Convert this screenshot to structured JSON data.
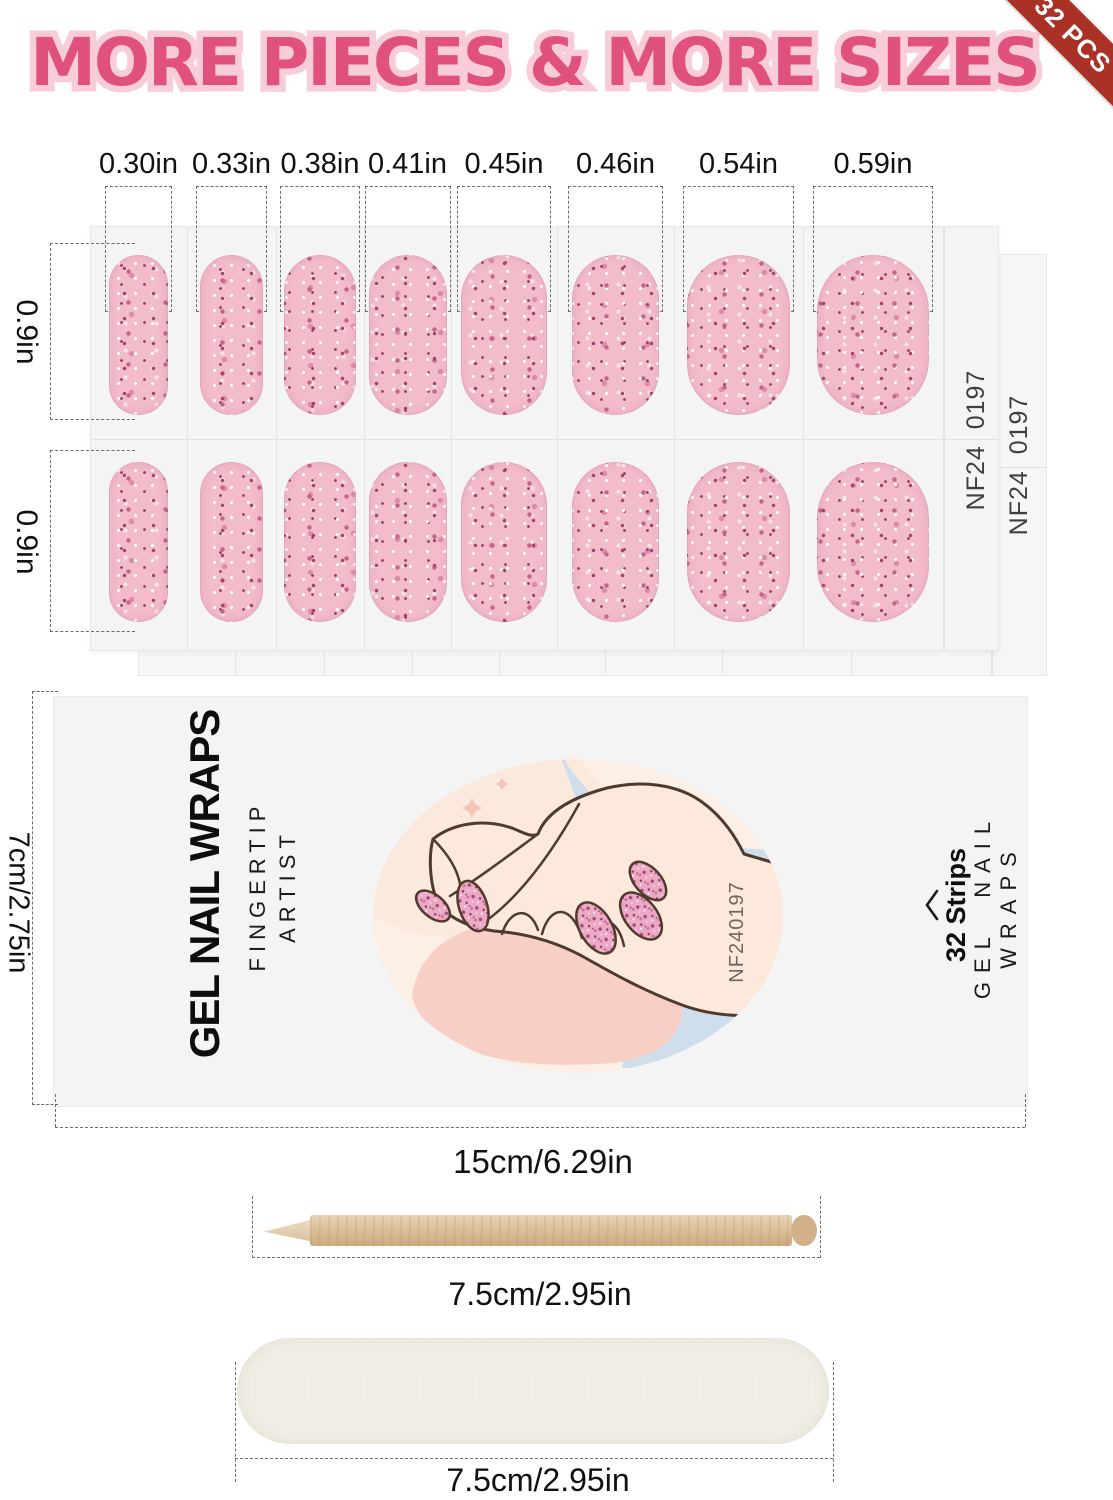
{
  "badge": {
    "label": "32 PCS"
  },
  "title": {
    "text": "MORE PIECES & MORE SIZES"
  },
  "sheet": {
    "size_labels": [
      "0.30in",
      "0.33in",
      "0.38in",
      "0.41in",
      "0.45in",
      "0.46in",
      "0.54in",
      "0.59in"
    ],
    "row_labels": [
      "0.9in",
      "0.9in"
    ],
    "front_code": "NF24  0197",
    "back_code": "NF24  0197"
  },
  "package": {
    "height_label": "7cm/2.75in",
    "width_label": "15cm/6.29in",
    "brand_title": "GEL NAIL WRAPS",
    "brand_subtitle": "FINGERTIP ARTIST",
    "product_code": "NF240197",
    "strips_label": "32 Strips",
    "side_label": "GEL NAIL WRAPS"
  },
  "tools": {
    "stick_label": "7.5cm/2.95in",
    "file_label": "7.5cm/2.95in"
  }
}
